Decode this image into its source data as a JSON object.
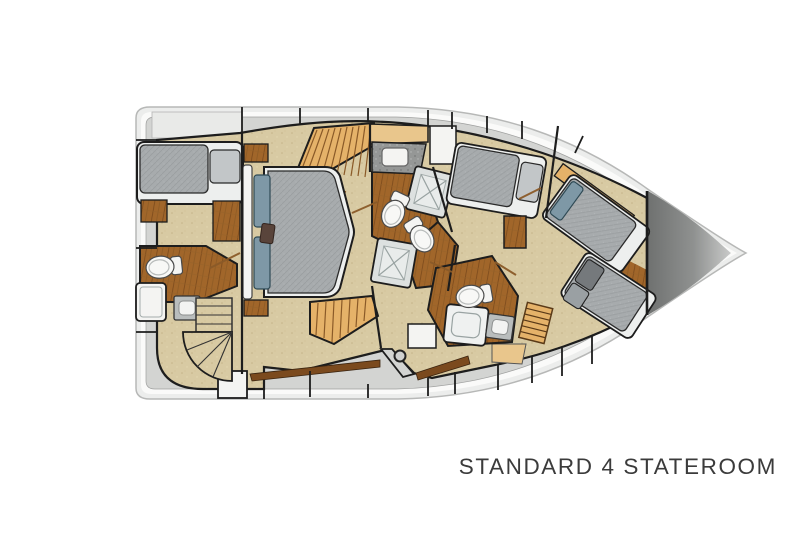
{
  "caption": {
    "text": "STANDARD 4 STATEROOM"
  },
  "colors": {
    "background": "#ffffff",
    "hull_rim": "#ecedec",
    "hull_stroke": "#b7b8b7",
    "hull_white": "#fafaf9",
    "deck": "#d3d4d2",
    "deck_line": "#9fa09f",
    "wall": "#1d1d1d",
    "carpet": "#d8caa3",
    "wood_floor": "#a1662a",
    "wood_dark": "#7b4a1e",
    "wood_trim": "#8a5a28",
    "wood_light": "#e5b269",
    "wood_counter": "#e9c68c",
    "mattress": "#a7abad",
    "pillow_gray": "#c2c6c8",
    "pillow_dark": "#75797c",
    "pillow_blue": "#7e98a6",
    "pillow_accent": "#59443b",
    "fixture": "#f4f4f2",
    "granite": "#959796",
    "shower": "#dde1e0",
    "bed_base": "#edefee",
    "bow_dark": "#6f7170",
    "bow_light": "#c9cac9",
    "caption": "#3b3b3b"
  }
}
